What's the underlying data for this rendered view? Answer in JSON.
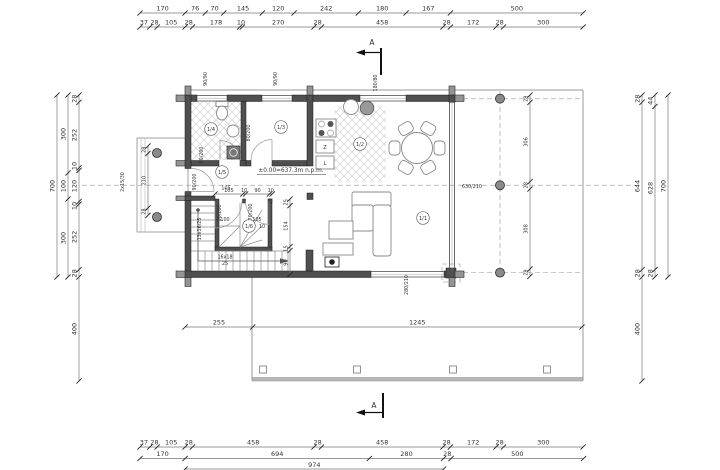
{
  "drawing": {
    "section_label": "A",
    "level_mark": "±0.00=637.3m n.p.m.",
    "rooms": {
      "bathroom": "1/4",
      "room": "1/3",
      "kitchen": "1/2",
      "hall": "1/5",
      "stair": "1/6",
      "living": "1/1"
    },
    "appliances": {
      "z": "Z",
      "l": "L"
    },
    "openings": {
      "entrance": "90/200",
      "bath_door": "80/200",
      "room_door": "80/200",
      "stair_door_left": "80/200",
      "stair_door_right": "70/200",
      "glass_wall": "630/210",
      "living_window": "280/210",
      "kitchen_window": "180/80",
      "bath_window": "90/90",
      "room_window": "90/90",
      "porch_steps": "2x15/30"
    },
    "stair_notes": {
      "run": "16x18",
      "run_b": "25",
      "winder": "13x16/25",
      "w10": "10",
      "d100": "100",
      "d105": "105",
      "hall105": "105"
    }
  },
  "dims": {
    "top1": [
      "170",
      "76",
      "70",
      "145",
      "120",
      "242",
      "180",
      "167",
      "500"
    ],
    "top2": [
      "37",
      "28",
      "105",
      "28",
      "178",
      "10",
      "270",
      "28",
      "458",
      "28",
      "172",
      "28",
      "300"
    ],
    "bottom1": [
      "37",
      "28",
      "105",
      "28",
      "458",
      "28",
      "458",
      "28",
      "172",
      "28",
      "300"
    ],
    "bottom2": [
      "170",
      "694",
      "280",
      "28",
      "500"
    ],
    "bottom3": [
      "974"
    ],
    "left_outer": [
      "700"
    ],
    "left_mid": [
      "300",
      "100",
      "300"
    ],
    "left_inner": [
      "28",
      "252",
      "10",
      "120",
      "10",
      "252",
      "28"
    ],
    "left_low": [
      "400"
    ],
    "right_inner": [
      "28",
      "644",
      "28"
    ],
    "right_low": [
      "400"
    ],
    "right_mid": [
      "44",
      "628",
      "28"
    ],
    "right_outer": [
      "700"
    ],
    "terrace_v": [
      "28",
      "306",
      "28",
      "308",
      "28"
    ],
    "terrace_h": [
      "255",
      "1245"
    ],
    "porch": [
      "28",
      "210",
      "28"
    ],
    "stair_top": [
      "105",
      "10",
      "90",
      "10"
    ],
    "stair_right": [
      "25",
      "154",
      "15",
      "90"
    ]
  },
  "colors": {
    "wall": "#4f4f4f",
    "log": "#949494",
    "dimline": "#777777",
    "text": "#333333",
    "terrace": "#9a9a9a"
  }
}
